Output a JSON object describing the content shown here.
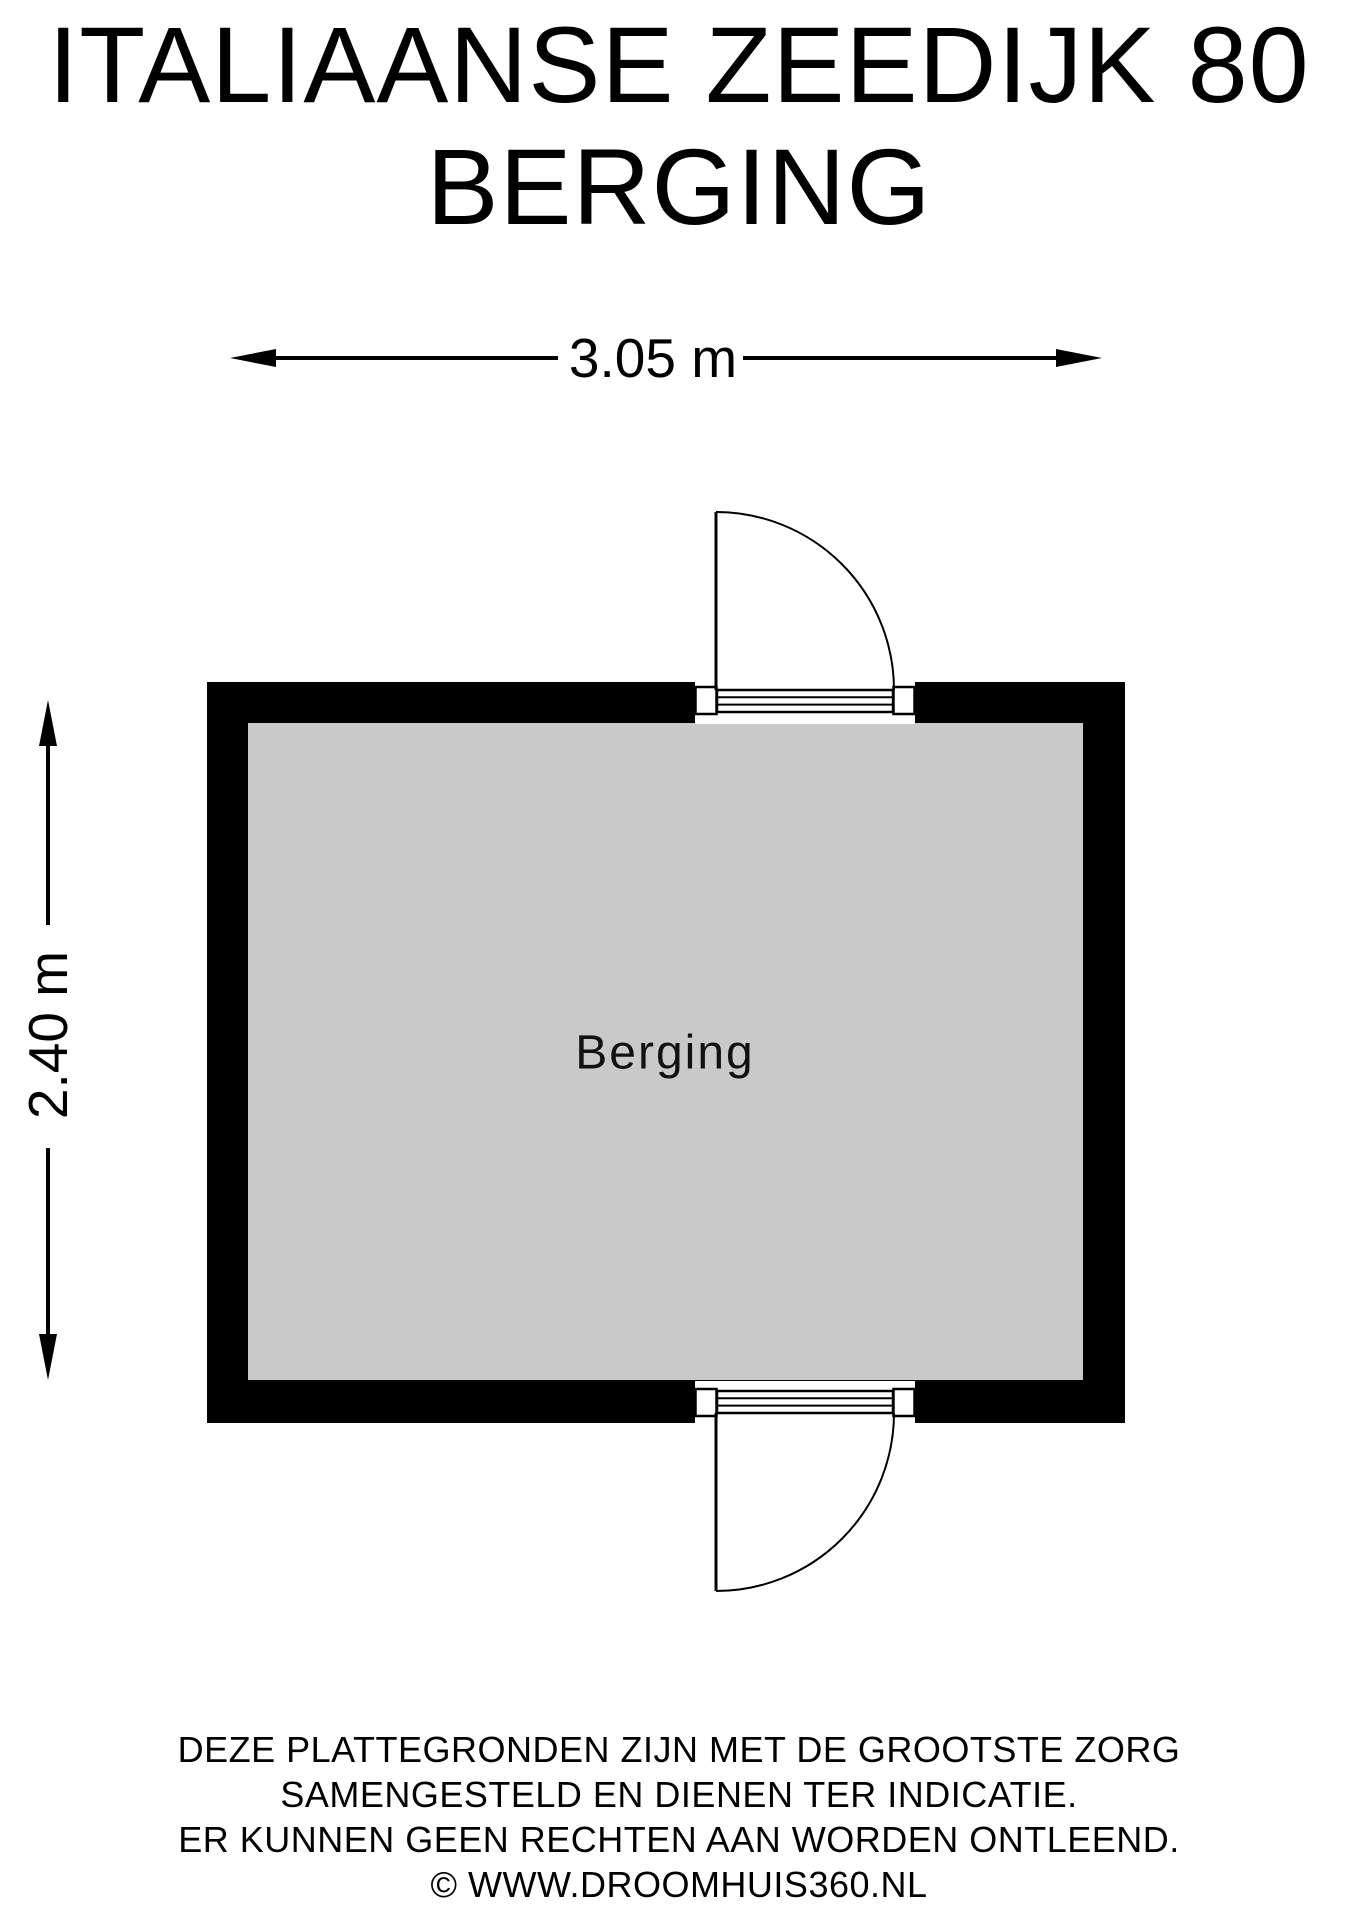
{
  "title": {
    "line1": "ITALIAANSE ZEEDIJK 80",
    "line2": "BERGING"
  },
  "dimensions": {
    "width_label": "3.05 m",
    "height_label": "2.40 m"
  },
  "room": {
    "label": "Berging"
  },
  "footer": {
    "line1": "DEZE PLATTEGRONDEN ZIJN MET DE GROOTSTE ZORG",
    "line2": "SAMENGESTELD EN DIENEN TER INDICATIE.",
    "line3": "ER KUNNEN GEEN RECHTEN AAN WORDEN ONTLEEND.",
    "line4": "© WWW.DROOMHUIS360.NL"
  },
  "colors": {
    "wall": "#000000",
    "floor": "#c9c9c9",
    "line": "#000000",
    "background": "#ffffff"
  }
}
